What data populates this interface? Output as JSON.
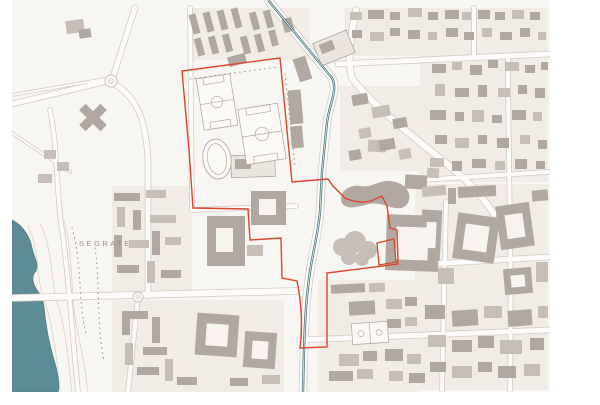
{
  "map": {
    "place_label": "SEGRATE",
    "label_pos": {
      "x": 79,
      "y": 246
    },
    "colors": {
      "sheet_bg": "#ffffff",
      "map_bg": "#f8f6f2",
      "parcel": "#f1ece6",
      "building_dark": "#b1a8a1",
      "building_mid": "#c6beb7",
      "building_light": "#ebe6e0",
      "building_outline": "#a79d95",
      "road_fill": "#fcfbf9",
      "road_casing": "#d3ccc5",
      "hole_fill": "#f7f4f0",
      "water": "#5d8b96",
      "water_edge": "#4f7d88",
      "canal": "#4d777e",
      "canal_core": "#e6eeee",
      "boundary_red": "#d9472f",
      "contour": "#ddd5c9",
      "treeline": "#a39b91",
      "label_gray": "#9a938c",
      "field_fill": "#fbfaf7",
      "field_stroke": "#b5ada3"
    },
    "content_area": {
      "x": 12,
      "y": 0,
      "w": 538,
      "h": 392
    },
    "water": {
      "lake": "M12,220 C24,226 30,238 32,248 C34,258 39,263 36,271 C30,277 33,285 39,293 C45,301 44,313 46,323 C48,339 52,353 56,367 C58,377 60,385 58,392 L12,392 Z",
      "canal": "M268,0 L332,78 C338,90 330,102 327,122 L322,172 L320,212 C317,242 311,257 308,287 C305,312 304,342 303,392"
    },
    "boundary": {
      "main": "M182,71 L280,58 L292,182 L328,179 L333,186 L345,198 C353,202 363,203 371,201 L382,196 L387,206 L390,228 L397,230 L398,264 L327,273 L327,347 L300,348 C303,325 301,300 297,281 L282,278 L281,238 L250,240 L248,209 L193,208 L189,150 Z",
      "annex": "M377,243 L394,239 L396,262 L379,265 Z"
    },
    "roads": [
      {
        "d": "M135,8 L112,80",
        "w": 5
      },
      {
        "d": "M112,80 L12,104",
        "w": 5
      },
      {
        "d": "M111,82 C138,96 146,122 148,160 L148,296",
        "w": 5
      },
      {
        "d": "M12,298 L296,291",
        "w": 6
      },
      {
        "d": "M268,0 L332,78 C338,90 330,102 327,122 L322,172 L320,212 C317,242 311,257 308,287 C305,312 304,342 303,392",
        "w": 7
      },
      {
        "d": "M356,10 C350,40 347,60 352,78 C370,104 420,142 452,168 C470,183 482,196 494,214",
        "w": 6
      },
      {
        "d": "M338,64 L548,54",
        "w": 5
      },
      {
        "d": "M474,8 L474,56",
        "w": 4
      },
      {
        "d": "M508,58 C508,150 512,260 510,390",
        "w": 4
      },
      {
        "d": "M420,180 L548,172",
        "w": 4
      },
      {
        "d": "M396,266 L548,257",
        "w": 5
      },
      {
        "d": "M300,340 L548,330",
        "w": 5
      },
      {
        "d": "M446,202 L442,390",
        "w": 4
      },
      {
        "d": "M192,210 L296,206",
        "w": 4
      },
      {
        "d": "M138,298 L128,392",
        "w": 4
      },
      {
        "d": "M50,110 C58,150 56,190 62,230 C68,270 72,330 78,392",
        "w": 4
      },
      {
        "d": "M190,8 L192,207",
        "w": 4
      },
      {
        "d": "M12,95 L105,79",
        "w": 2
      },
      {
        "d": "M12,133 L70,172",
        "w": 2
      }
    ],
    "roundabouts": [
      [
        111,
        81,
        6
      ],
      [
        138,
        297,
        5
      ]
    ],
    "parcels": [
      [
        188,
        8,
        122,
        52
      ],
      [
        345,
        8,
        203,
        48
      ],
      [
        420,
        56,
        128,
        126
      ],
      [
        415,
        184,
        133,
        206
      ],
      [
        112,
        186,
        80,
        106
      ],
      [
        112,
        300,
        172,
        92
      ],
      [
        318,
        280,
        100,
        112
      ],
      [
        340,
        86,
        80,
        85
      ]
    ],
    "contours": [
      "M28,226 C40,250 36,280 44,300 C52,322 56,350 60,392",
      "M40,223 C54,252 50,282 58,305 C66,330 68,358 72,392",
      "M20,230 C30,255 26,282 34,302 C42,325 46,352 50,392",
      "M64,220 C74,256 70,300 78,334 C84,360 86,376 88,392"
    ],
    "treelines": [
      "M72,228 C82,262 78,302 86,334",
      "M95,248 C100,280 96,320 104,362",
      "M190,79 L278,67",
      "M285,74 L295,166"
    ],
    "buildings": [
      [
        66,
        20,
        18,
        13,
        -8,
        1
      ],
      [
        79,
        29,
        12,
        9,
        -8,
        0
      ],
      [
        44,
        150,
        12,
        9,
        0,
        1
      ],
      [
        57,
        162,
        12,
        9,
        0,
        1
      ],
      [
        38,
        174,
        14,
        9,
        0,
        1
      ],
      [
        78,
        113,
        30,
        9,
        45,
        0
      ],
      [
        78,
        113,
        30,
        9,
        -45,
        0
      ],
      [
        191,
        14,
        7,
        20,
        -15,
        0
      ],
      [
        205,
        12,
        7,
        20,
        -15,
        0
      ],
      [
        219,
        10,
        7,
        20,
        -15,
        0
      ],
      [
        233,
        8,
        7,
        20,
        -15,
        0
      ],
      [
        251,
        12,
        7,
        18,
        -15,
        0
      ],
      [
        265,
        10,
        7,
        18,
        -15,
        0
      ],
      [
        196,
        38,
        7,
        18,
        -15,
        0
      ],
      [
        210,
        36,
        7,
        18,
        -15,
        0
      ],
      [
        224,
        34,
        7,
        18,
        -15,
        0
      ],
      [
        242,
        36,
        7,
        18,
        -15,
        0
      ],
      [
        256,
        34,
        7,
        18,
        -15,
        0
      ],
      [
        270,
        30,
        7,
        16,
        -15,
        0
      ],
      [
        283,
        18,
        10,
        14,
        -15,
        0
      ],
      [
        228,
        55,
        18,
        10,
        -15,
        0
      ],
      [
        316,
        36,
        36,
        24,
        -22,
        2
      ],
      [
        320,
        42,
        14,
        10,
        -22,
        0
      ],
      [
        289,
        90,
        13,
        34,
        -5,
        0
      ],
      [
        291,
        126,
        12,
        22,
        -5,
        0
      ],
      [
        296,
        57,
        13,
        24,
        -18,
        0
      ],
      [
        114,
        193,
        26,
        8,
        0,
        0
      ],
      [
        146,
        190,
        20,
        8,
        0,
        1
      ],
      [
        117,
        207,
        8,
        20,
        0,
        1
      ],
      [
        133,
        210,
        8,
        20,
        0,
        0
      ],
      [
        150,
        215,
        26,
        8,
        0,
        1
      ],
      [
        114,
        235,
        8,
        22,
        0,
        0
      ],
      [
        129,
        240,
        20,
        8,
        0,
        1
      ],
      [
        152,
        231,
        8,
        24,
        0,
        0
      ],
      [
        165,
        237,
        16,
        8,
        0,
        1
      ],
      [
        117,
        265,
        22,
        8,
        0,
        0
      ],
      [
        147,
        261,
        8,
        22,
        0,
        1
      ],
      [
        161,
        270,
        20,
        8,
        0,
        0
      ],
      [
        231,
        155,
        44,
        22,
        -2,
        2
      ],
      [
        235,
        159,
        16,
        10,
        -2,
        0
      ],
      [
        207,
        216,
        38,
        50,
        0,
        0
      ],
      [
        251,
        191,
        35,
        34,
        0,
        0
      ],
      [
        247,
        245,
        16,
        11,
        0,
        1
      ],
      [
        368,
        140,
        18,
        12,
        3,
        1
      ],
      [
        405,
        175,
        22,
        14,
        3,
        0
      ],
      [
        427,
        168,
        12,
        10,
        3,
        1
      ],
      [
        386,
        215,
        53,
        56,
        2,
        0
      ],
      [
        400,
        232,
        10,
        12,
        2,
        0
      ],
      [
        414,
        232,
        12,
        14,
        2,
        0
      ],
      [
        331,
        284,
        34,
        9,
        -3,
        0
      ],
      [
        369,
        283,
        16,
        9,
        -3,
        1
      ],
      [
        349,
        301,
        26,
        14,
        -3,
        0
      ],
      [
        386,
        299,
        16,
        10,
        0,
        1
      ],
      [
        405,
        297,
        12,
        9,
        0,
        0
      ],
      [
        387,
        319,
        14,
        9,
        0,
        0
      ],
      [
        405,
        317,
        12,
        9,
        0,
        1
      ],
      [
        339,
        354,
        20,
        12,
        0,
        1
      ],
      [
        363,
        351,
        14,
        10,
        0,
        0
      ],
      [
        329,
        371,
        24,
        10,
        0,
        0
      ],
      [
        357,
        369,
        16,
        10,
        0,
        1
      ],
      [
        385,
        349,
        18,
        12,
        0,
        0
      ],
      [
        407,
        354,
        14,
        10,
        0,
        1
      ],
      [
        389,
        371,
        14,
        10,
        0,
        1
      ],
      [
        409,
        373,
        16,
        10,
        0,
        0
      ],
      [
        196,
        314,
        42,
        42,
        4,
        0
      ],
      [
        244,
        332,
        32,
        36,
        4,
        0
      ],
      [
        122,
        311,
        26,
        8,
        0,
        0
      ],
      [
        122,
        311,
        8,
        24,
        0,
        0
      ],
      [
        152,
        317,
        8,
        26,
        0,
        0
      ],
      [
        143,
        347,
        24,
        8,
        0,
        0
      ],
      [
        125,
        343,
        8,
        22,
        0,
        1
      ],
      [
        137,
        367,
        22,
        8,
        0,
        0
      ],
      [
        165,
        359,
        8,
        22,
        0,
        1
      ],
      [
        177,
        377,
        20,
        8,
        0,
        0
      ],
      [
        262,
        375,
        18,
        9,
        0,
        1
      ],
      [
        230,
        378,
        18,
        8,
        0,
        0
      ],
      [
        350,
        12,
        12,
        8,
        0,
        1
      ],
      [
        368,
        10,
        16,
        9,
        0,
        0
      ],
      [
        390,
        12,
        10,
        8,
        0,
        0
      ],
      [
        408,
        8,
        14,
        9,
        0,
        1
      ],
      [
        428,
        12,
        10,
        8,
        0,
        0
      ],
      [
        445,
        10,
        14,
        9,
        0,
        0
      ],
      [
        462,
        12,
        9,
        8,
        0,
        1
      ],
      [
        478,
        10,
        12,
        9,
        0,
        0
      ],
      [
        495,
        12,
        10,
        8,
        0,
        0
      ],
      [
        512,
        10,
        12,
        9,
        0,
        1
      ],
      [
        530,
        12,
        10,
        8,
        0,
        0
      ],
      [
        352,
        30,
        10,
        8,
        0,
        0
      ],
      [
        370,
        32,
        14,
        9,
        0,
        1
      ],
      [
        390,
        28,
        10,
        8,
        0,
        0
      ],
      [
        408,
        30,
        12,
        9,
        0,
        0
      ],
      [
        428,
        32,
        9,
        8,
        0,
        1
      ],
      [
        446,
        28,
        12,
        9,
        0,
        0
      ],
      [
        464,
        32,
        10,
        8,
        0,
        0
      ],
      [
        482,
        28,
        10,
        9,
        0,
        1
      ],
      [
        500,
        32,
        12,
        8,
        0,
        0
      ],
      [
        520,
        28,
        10,
        9,
        0,
        0
      ],
      [
        538,
        32,
        8,
        8,
        0,
        1
      ],
      [
        432,
        64,
        14,
        9,
        0,
        0
      ],
      [
        452,
        62,
        10,
        8,
        0,
        1
      ],
      [
        470,
        65,
        12,
        10,
        0,
        0
      ],
      [
        488,
        60,
        10,
        8,
        0,
        0
      ],
      [
        505,
        62,
        14,
        9,
        0,
        1
      ],
      [
        525,
        65,
        10,
        8,
        0,
        0
      ],
      [
        541,
        62,
        7,
        8,
        0,
        0
      ],
      [
        435,
        84,
        10,
        12,
        0,
        1
      ],
      [
        455,
        88,
        14,
        9,
        0,
        0
      ],
      [
        478,
        85,
        9,
        12,
        0,
        0
      ],
      [
        498,
        88,
        12,
        9,
        0,
        1
      ],
      [
        518,
        85,
        9,
        9,
        0,
        0
      ],
      [
        535,
        88,
        10,
        10,
        0,
        0
      ],
      [
        430,
        110,
        16,
        10,
        0,
        0
      ],
      [
        455,
        112,
        9,
        9,
        0,
        0
      ],
      [
        472,
        110,
        12,
        12,
        0,
        1
      ],
      [
        492,
        115,
        10,
        8,
        0,
        0
      ],
      [
        512,
        110,
        14,
        10,
        0,
        0
      ],
      [
        533,
        112,
        9,
        9,
        0,
        1
      ],
      [
        435,
        135,
        12,
        9,
        0,
        0
      ],
      [
        455,
        138,
        14,
        10,
        0,
        1
      ],
      [
        478,
        135,
        9,
        9,
        0,
        0
      ],
      [
        497,
        138,
        12,
        10,
        0,
        0
      ],
      [
        520,
        135,
        10,
        9,
        0,
        1
      ],
      [
        538,
        140,
        9,
        9,
        0,
        0
      ],
      [
        430,
        158,
        14,
        9,
        0,
        1
      ],
      [
        452,
        161,
        10,
        10,
        0,
        0
      ],
      [
        472,
        159,
        14,
        9,
        0,
        0
      ],
      [
        495,
        161,
        10,
        9,
        0,
        1
      ],
      [
        515,
        159,
        12,
        10,
        0,
        0
      ],
      [
        536,
        161,
        9,
        8,
        0,
        0
      ],
      [
        352,
        94,
        16,
        11,
        -10,
        0
      ],
      [
        372,
        106,
        18,
        11,
        -10,
        1
      ],
      [
        393,
        118,
        14,
        10,
        -10,
        0
      ],
      [
        359,
        128,
        12,
        10,
        -10,
        1
      ],
      [
        379,
        139,
        16,
        11,
        -10,
        0
      ],
      [
        399,
        149,
        12,
        10,
        -10,
        1
      ],
      [
        349,
        150,
        12,
        10,
        -10,
        0
      ],
      [
        422,
        186,
        24,
        10,
        -5,
        1
      ],
      [
        448,
        188,
        8,
        16,
        0,
        0
      ],
      [
        458,
        186,
        38,
        11,
        -3,
        0
      ],
      [
        532,
        190,
        16,
        11,
        -5,
        0
      ],
      [
        421,
        210,
        20,
        50,
        3,
        0
      ],
      [
        455,
        215,
        42,
        46,
        8,
        0
      ],
      [
        498,
        204,
        34,
        44,
        -8,
        0
      ],
      [
        438,
        268,
        16,
        16,
        0,
        1
      ],
      [
        504,
        268,
        28,
        26,
        -5,
        0
      ],
      [
        536,
        262,
        12,
        20,
        0,
        1
      ],
      [
        425,
        305,
        20,
        14,
        0,
        0
      ],
      [
        452,
        310,
        26,
        16,
        -4,
        0
      ],
      [
        484,
        306,
        18,
        12,
        0,
        1
      ],
      [
        508,
        310,
        24,
        16,
        -4,
        0
      ],
      [
        538,
        306,
        10,
        12,
        0,
        1
      ],
      [
        428,
        335,
        18,
        12,
        0,
        1
      ],
      [
        452,
        340,
        20,
        12,
        0,
        0
      ],
      [
        478,
        336,
        16,
        12,
        0,
        0
      ],
      [
        500,
        340,
        22,
        14,
        0,
        1
      ],
      [
        530,
        338,
        14,
        12,
        0,
        0
      ],
      [
        430,
        362,
        16,
        10,
        0,
        0
      ],
      [
        452,
        366,
        20,
        12,
        0,
        1
      ],
      [
        478,
        362,
        14,
        10,
        0,
        0
      ],
      [
        498,
        366,
        18,
        12,
        0,
        0
      ],
      [
        524,
        364,
        16,
        12,
        0,
        1
      ]
    ],
    "holes": [
      [
        216,
        228,
        17,
        24,
        0
      ],
      [
        259,
        199,
        17,
        16,
        0
      ],
      [
        396,
        227,
        32,
        33,
        2
      ],
      [
        206,
        324,
        22,
        22,
        4
      ],
      [
        252,
        341,
        16,
        18,
        4
      ],
      [
        426,
        222,
        10,
        26,
        3
      ],
      [
        464,
        225,
        24,
        26,
        8
      ],
      [
        506,
        214,
        18,
        24,
        -8
      ],
      [
        511,
        275,
        14,
        12,
        -5
      ]
    ],
    "blobs": {
      "amoeba": "M342,203 C338,192 349,184 361,186 C371,188 377,181 388,181 C398,181 407,186 409,194 C411,202 405,210 395,208 C385,206 379,202 369,204 C359,206 348,211 342,203 Z",
      "clover": [
        [
          342,
          247,
          9
        ],
        [
          355,
          242,
          11
        ],
        [
          368,
          250,
          9
        ],
        [
          349,
          257,
          8
        ],
        [
          362,
          259,
          7
        ]
      ]
    },
    "sports": {
      "fields": [
        {
          "cx": 217,
          "cy": 102,
          "w": 34,
          "h": 52,
          "rot": -9
        },
        {
          "cx": 262,
          "cy": 134,
          "w": 40,
          "h": 56,
          "rot": -9
        }
      ],
      "track": {
        "cx": 217,
        "cy": 159,
        "rx": 14,
        "ry": 20,
        "rot": -9
      },
      "court": {
        "cx": 370,
        "cy": 333,
        "w": 36,
        "h": 21,
        "rot": -4
      }
    }
  }
}
